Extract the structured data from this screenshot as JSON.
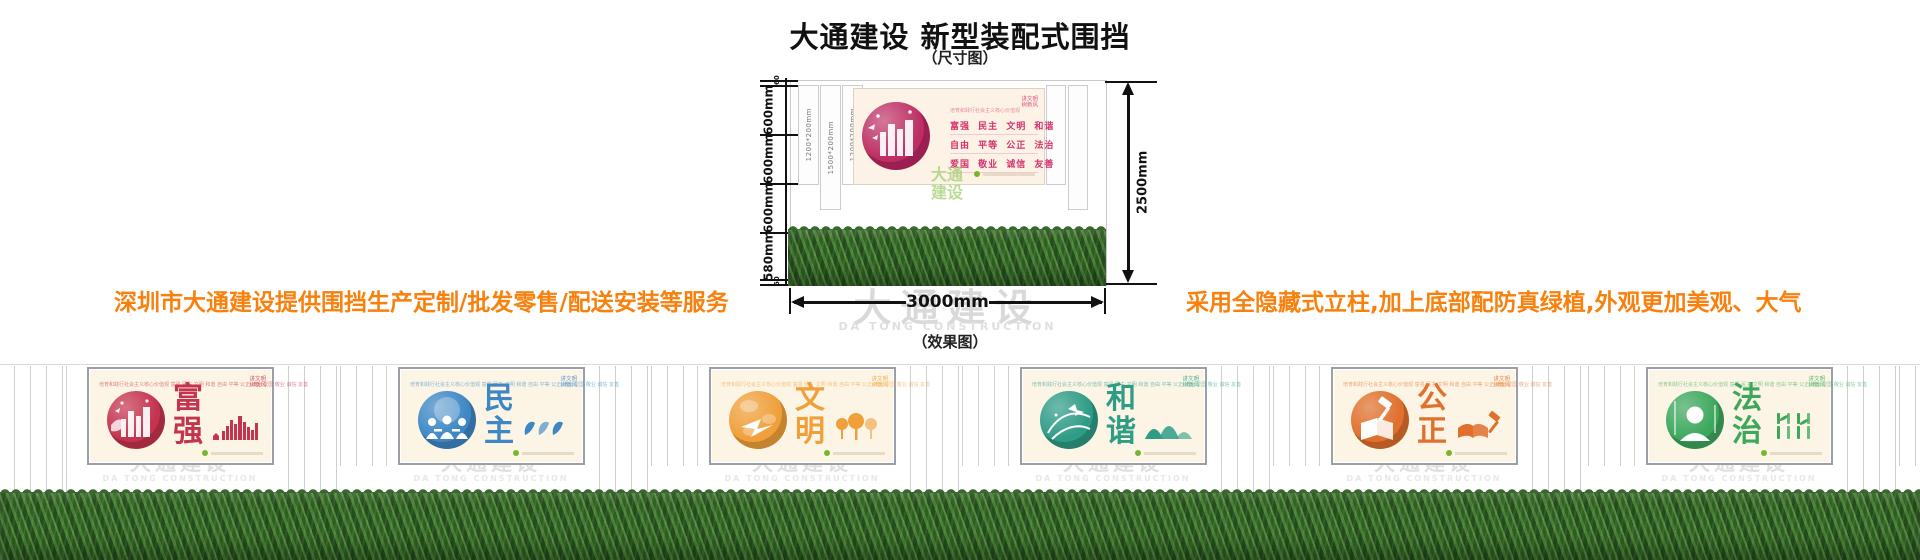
{
  "title": "大通建设 新型装配式围挡",
  "labels": {
    "size_view": "（尺寸图）",
    "effect_view": "（效果图）"
  },
  "left_note": "深圳市大通建设提供围挡生产定制/批发零售/配送安装等服务",
  "right_note": "采用全隐藏式立柱,加上底部配防真绿植,外观更加美观、大气",
  "dims": {
    "total_height": "2500mm",
    "total_width": "3000mm",
    "segments": [
      "60",
      "600mm",
      "600mm",
      "600mm",
      "580mm",
      "60"
    ],
    "posts": [
      "1200*200mm",
      "1500*200mm",
      "1200*200mm"
    ]
  },
  "values_panel": {
    "header_line": "培育和践行社会主义核心价值观",
    "corner_line1": "讲文明",
    "corner_line2": "树新风",
    "rows": [
      "富强 民主 文明 和谐",
      "自由 平等 公正 法治",
      "爱国 敬业 诚信 友善"
    ]
  },
  "watermark": {
    "cn": "大通建设",
    "en": "DA TONG CONSTRUCTION"
  },
  "green_logo": {
    "line1": "大通",
    "line2": "建设"
  },
  "panel_common": {
    "header_line": "培育和践行社会主义核心价值观  富强 民主 文明 和谐 自由 平等 公正 法治 爱国 敬业 诚信 友善",
    "corner_line1": "讲文明",
    "corner_line2": "树新风"
  },
  "panels": [
    {
      "name": "fuqiang",
      "word_top": "富",
      "word_bottom": "强",
      "color": "#c5344e",
      "color_dark": "#97223c",
      "icon": "city-skyline"
    },
    {
      "name": "minzhu",
      "word_top": "民",
      "word_bottom": "主",
      "color": "#3e87c4",
      "color_dark": "#2a6397",
      "icon": "doves"
    },
    {
      "name": "wenming",
      "word_top": "文",
      "word_bottom": "明",
      "color": "#efa03a",
      "color_dark": "#c97b1e",
      "icon": "trees"
    },
    {
      "name": "hexie",
      "word_top": "和",
      "word_bottom": "谐",
      "color": "#2f9c86",
      "color_dark": "#1d7363",
      "icon": "mountains"
    },
    {
      "name": "gongzheng",
      "word_top": "公",
      "word_bottom": "正",
      "color": "#e0702c",
      "color_dark": "#b24f16",
      "icon": "book-gavel"
    },
    {
      "name": "fazhi",
      "word_top": "法",
      "word_bottom": "治",
      "color": "#3da85c",
      "color_dark": "#27813f",
      "icon": "bamboo"
    }
  ],
  "colors": {
    "accent_orange": "#f8800d",
    "values_pink": "#d5346e",
    "watermark_gray": "#d9d9d9",
    "hedge_green": "#2f5f23",
    "panel_cream": "#fcf5e6",
    "green_logo": "#8cc350"
  }
}
